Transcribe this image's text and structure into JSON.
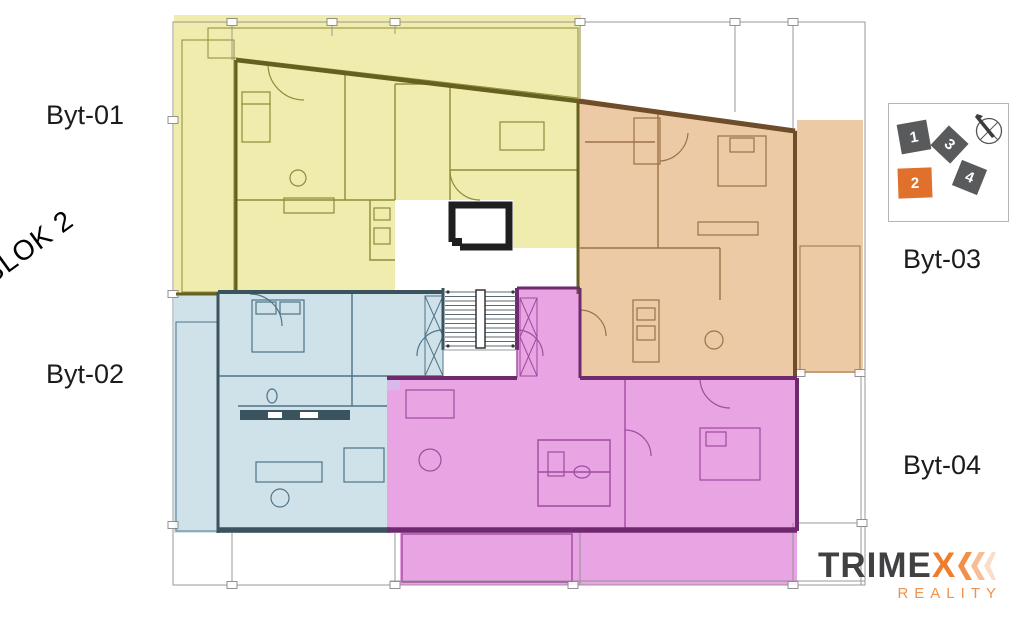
{
  "plan": {
    "block_label": "BLOK 2",
    "apartments": [
      {
        "id": "byt-01",
        "label": "Byt-01"
      },
      {
        "id": "byt-02",
        "label": "Byt-02"
      },
      {
        "id": "byt-03",
        "label": "Byt-03"
      },
      {
        "id": "byt-04",
        "label": "Byt-04"
      }
    ]
  },
  "legend": {
    "items": [
      {
        "label": "1"
      },
      {
        "label": "2"
      },
      {
        "label": "3"
      },
      {
        "label": "4"
      }
    ]
  },
  "logo": {
    "text_main": "TRIME",
    "text_accent": "X",
    "tagline": "REALITY"
  },
  "colors": {
    "yellow_fill": "#efecae",
    "yellow_line": "#8e8c38",
    "yellow_wall": "#65601f",
    "orange_fill": "#eccaa5",
    "orange_line": "#9b7146",
    "orange_wall": "#6f4d2a",
    "blue_fill": "#cfe2ea",
    "blue_line": "#4f7387",
    "blue_wall": "#3a535f",
    "magenta_fill": "#e9a4e3",
    "magenta_line": "#a04ba0",
    "magenta_wall": "#6f2a6f",
    "accent_orange": "#e0712c",
    "legend_dark": "#595a5c",
    "logo_dark": "#414042",
    "logo_orange": "#ef7d2c",
    "tagline_orange": "#f0924c",
    "grid_gray": "#8f8f8f",
    "text_dark": "#1c1c1e"
  }
}
